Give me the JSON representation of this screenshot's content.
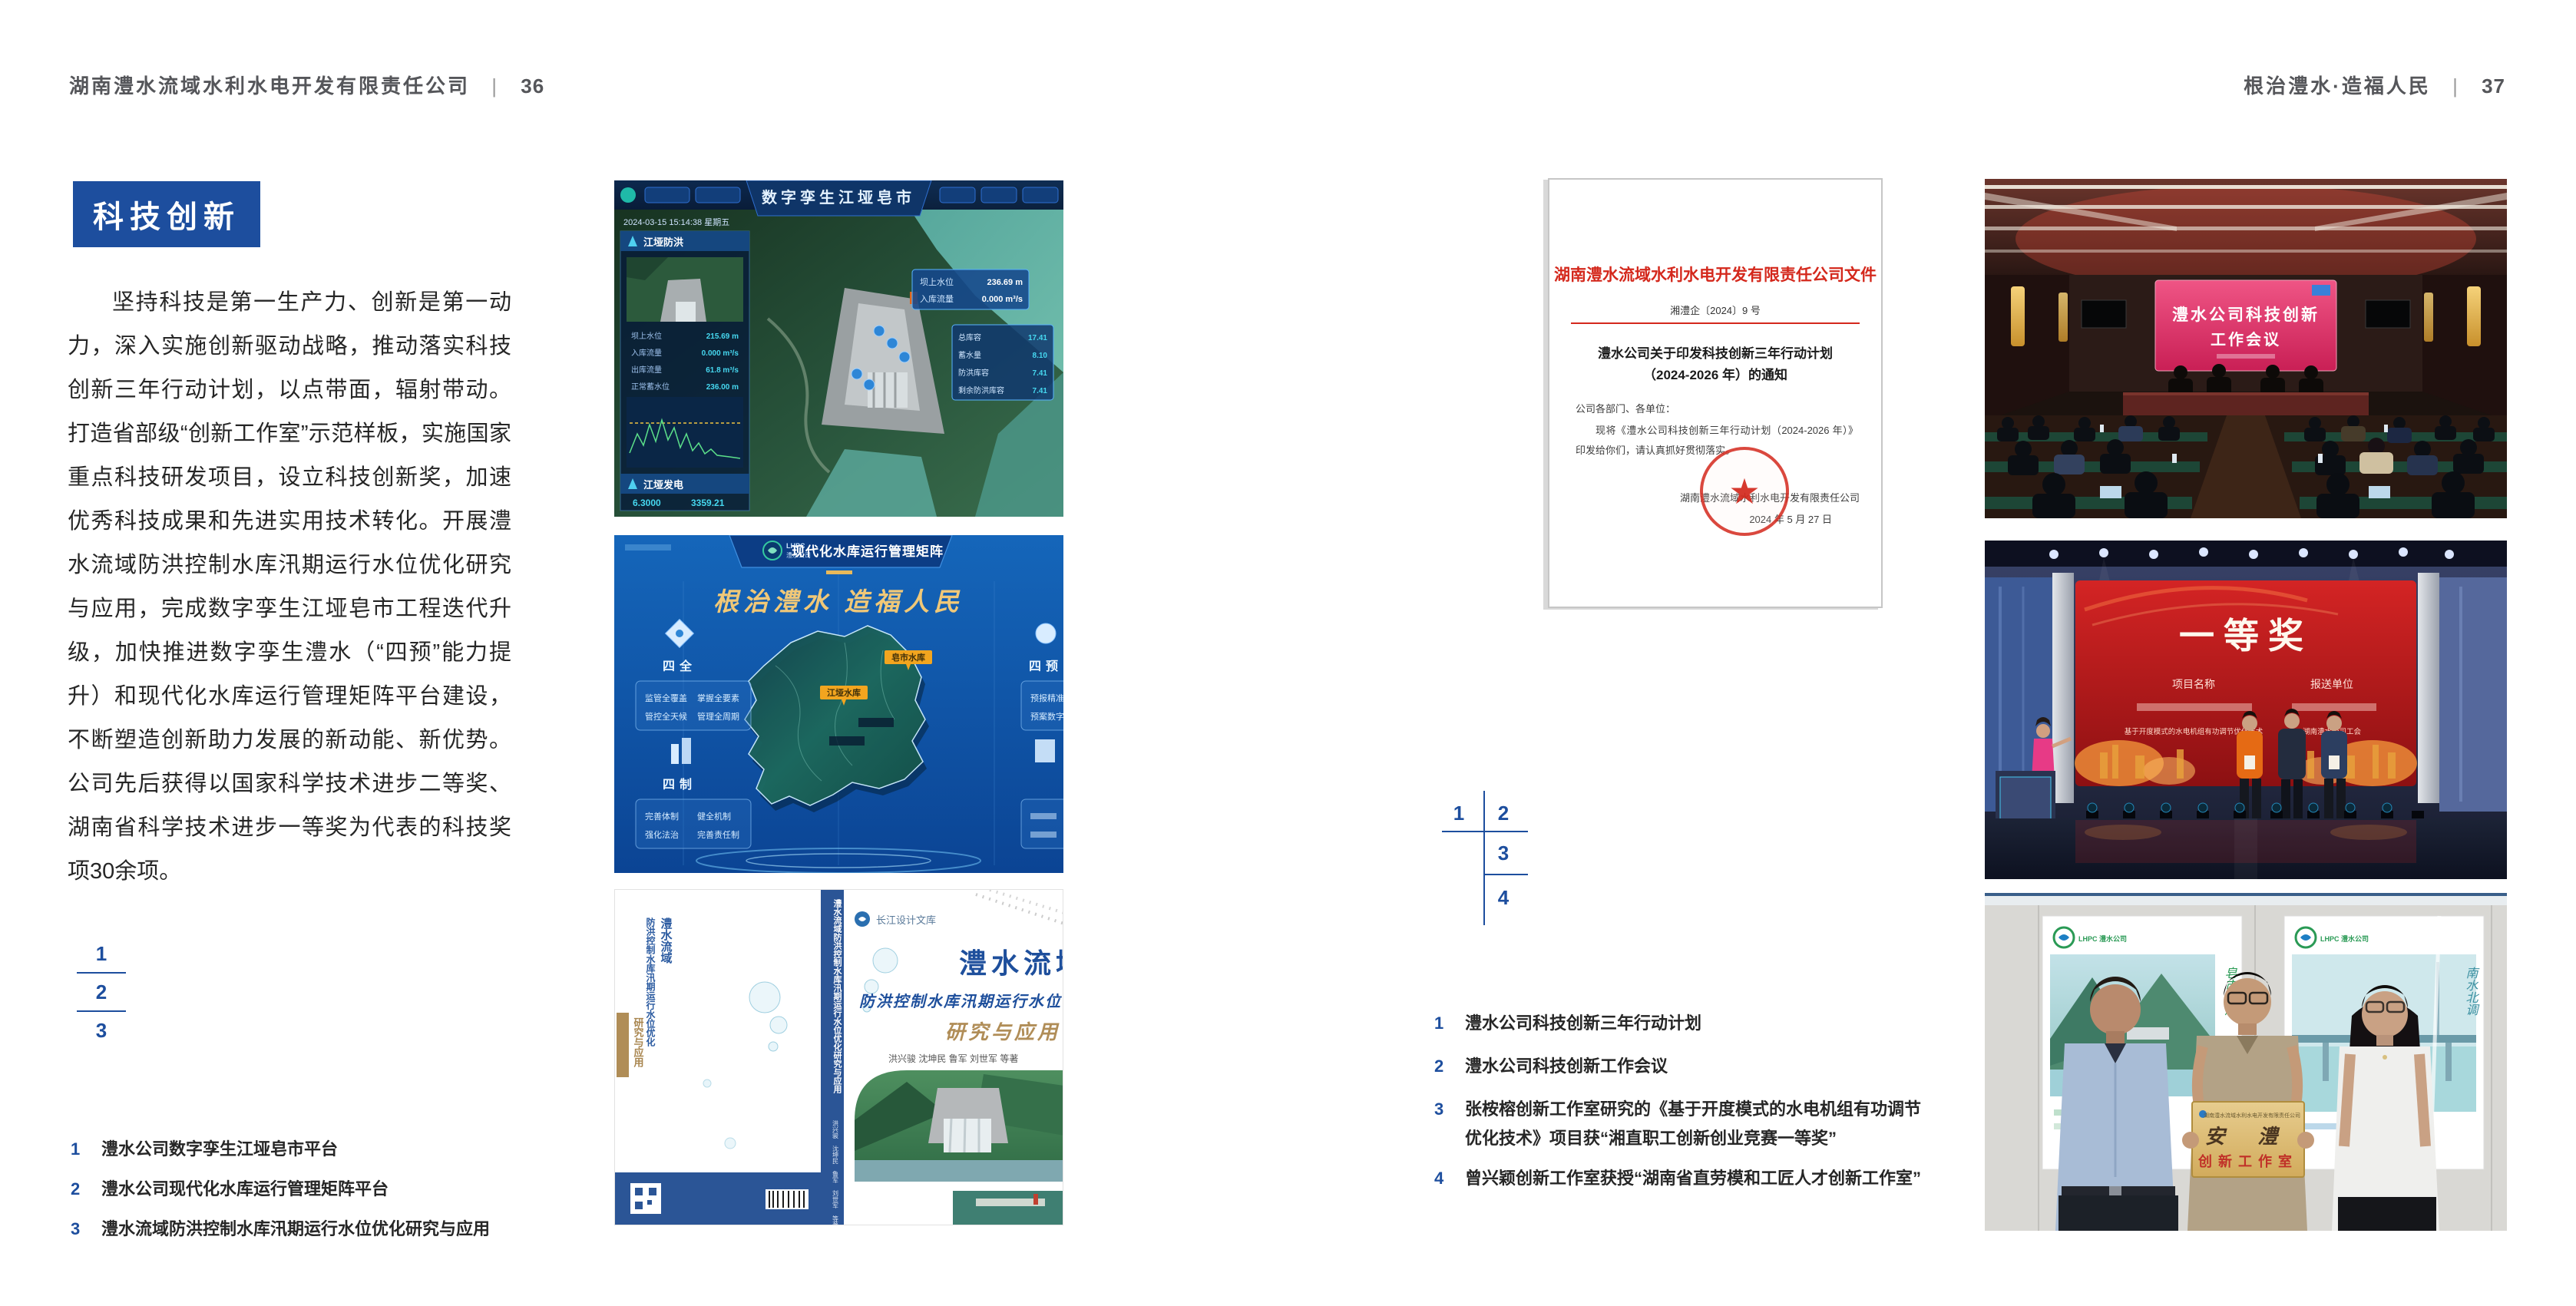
{
  "page_left": {
    "header": {
      "title": "湖南澧水流域水利水电开发有限责任公司",
      "divider": "|",
      "page_no": "36"
    },
    "section_title": "科技创新",
    "paragraph": "坚持科技是第一生产力、创新是第一动力，深入实施创新驱动战略，推动落实科技创新三年行动计划，以点带面，辐射带动。打造省部级“创新工作室”示范样板，实施国家重点科技研发项目，设立科技创新奖，加速优秀科技成果和先进实用技术转化。开展澧水流域防洪控制水库汛期运行水位优化研究与应用，完成数字孪生江垭皂市工程迭代升级，加快推进数字孪生澧水（“四预”能力提升）和现代化水库运行管理矩阵平台建设，不断塑造创新助力发展的新动能、新优势。公司先后获得以国家科学技术进步二等奖、湖南省科学技术进步一等奖为代表的科技奖项30余项。",
    "figure_key": [
      "1",
      "2",
      "3"
    ],
    "captions": [
      {
        "num": "1",
        "text": "澧水公司数字孪生江垭皂市平台"
      },
      {
        "num": "2",
        "text": "澧水公司现代化水库运行管理矩阵平台"
      },
      {
        "num": "3",
        "text": "澧水流域防洪控制水库汛期运行水位优化研究与应用"
      }
    ]
  },
  "page_right": {
    "header": {
      "title": "根治澧水·造福人民",
      "divider": "|",
      "page_no": "37"
    },
    "figure_key": [
      "1",
      "2",
      "3",
      "4"
    ],
    "captions": [
      {
        "num": "1",
        "text": "澧水公司科技创新三年行动计划"
      },
      {
        "num": "2",
        "text": "澧水公司科技创新工作会议"
      },
      {
        "num": "3",
        "line1": "张桉榕创新工作室研究的《基于开度模式的水电机组有功调节",
        "line2": "优化技术》项目获“湘直职工创新创业竞赛一等奖”"
      },
      {
        "num": "4",
        "text": "曾兴颖创新工作室获授“湖南省直劳模和工匠人才创新工作室”"
      }
    ]
  },
  "figures": {
    "dashboard": {
      "title": "数字孪生江垭皂市",
      "datetime": "2024-03-15 15:14:38 星期五",
      "panel1": "江垭防洪",
      "panel2": "江垭发电",
      "stats": [
        {
          "label": "坝上水位",
          "value": "215.69 m"
        },
        {
          "label": "入库流量",
          "value": "0.000 m³/s"
        },
        {
          "label": "出库流量",
          "value": "61.8 m³/s"
        },
        {
          "label": "正常蓄水位",
          "value": "236.00 m"
        }
      ],
      "gen_values": [
        "6.3000",
        "3359.21"
      ],
      "tooltip": [
        {
          "label": "坝上水位",
          "value": "236.69 m"
        },
        {
          "label": "入库流量",
          "value": "0.000 m³/s"
        }
      ],
      "reservoir_panel": [
        {
          "label": "总库容",
          "value": "17.41"
        },
        {
          "label": "蓄水量",
          "value": "8.10"
        },
        {
          "label": "防洪库容",
          "value": "7.41"
        },
        {
          "label": "剩余防洪库容",
          "value": "7.41"
        }
      ]
    },
    "matrix": {
      "brand_en": "LHPC",
      "brand": "澧水公司",
      "title": "现代化水库运行管理矩阵",
      "slogan": "根治澧水 造福人民",
      "panels": [
        {
          "label": "四全",
          "items": [
            "监管全覆盖",
            "掌握全要素",
            "管控全天候",
            "管理全周期"
          ]
        },
        {
          "label": "四制",
          "items": [
            "完善体制",
            "健全机制",
            "强化法治",
            "完善责任制"
          ]
        },
        {
          "label": "四预",
          "items": [
            "预报精准化",
            "预案数字化"
          ]
        }
      ],
      "map_tags": [
        "江垭水库",
        "皂市水库"
      ]
    },
    "book": {
      "series": "长江设计文库",
      "title": "澧水流域",
      "subtitle": "防洪控制水库汛期运行水位优化",
      "subtitle2": "研究与应用",
      "authors": "洪兴骏 沈坤民 鲁军 刘世军 等著",
      "spine": "澧水流域防洪控制水库汛期运行水位优化研究与应用"
    },
    "document": {
      "header": "湖南澧水流域水利水电开发有限责任公司文件",
      "doc_no": "湘澧企〔2024〕9 号",
      "title_line1": "澧水公司关于印发科技创新三年行动计划",
      "title_line2": "（2024-2026 年）的通知",
      "salutation": "公司各部门、各单位：",
      "body": "现将《澧水公司科技创新三年行动计划（2024-2026 年）》印发给你们，请认真抓好贯彻落实。",
      "seal_star": "★",
      "signer": "湖南澧水流域水利水电开发有限责任公司",
      "date": "2024 年 5 月 27 日"
    },
    "meeting": {
      "screen_line1": "澧水公司科技创新",
      "screen_line2": "工作会议"
    },
    "award": {
      "title": "一等奖",
      "col1": "项目名称",
      "col2": "报送单位",
      "row_project": "基于开度模式的水电机组有功调节优化技术",
      "row_unit": "湖南澧水公司工会"
    },
    "workshop": {
      "logo": "LHPC 澧水公司",
      "poster_left_text": "皂市水库",
      "poster_right_text": "南水北调",
      "plaque_header": "湖南澧水流域水利水电开发有限责任公司",
      "plaque_title": "安 澧",
      "plaque_sub": "创新工作室"
    }
  },
  "colors": {
    "accent_blue": "#1d4e9e",
    "doc_red": "#d4281c",
    "spine_blue": "#2b5596",
    "award_red": "#c01818"
  }
}
